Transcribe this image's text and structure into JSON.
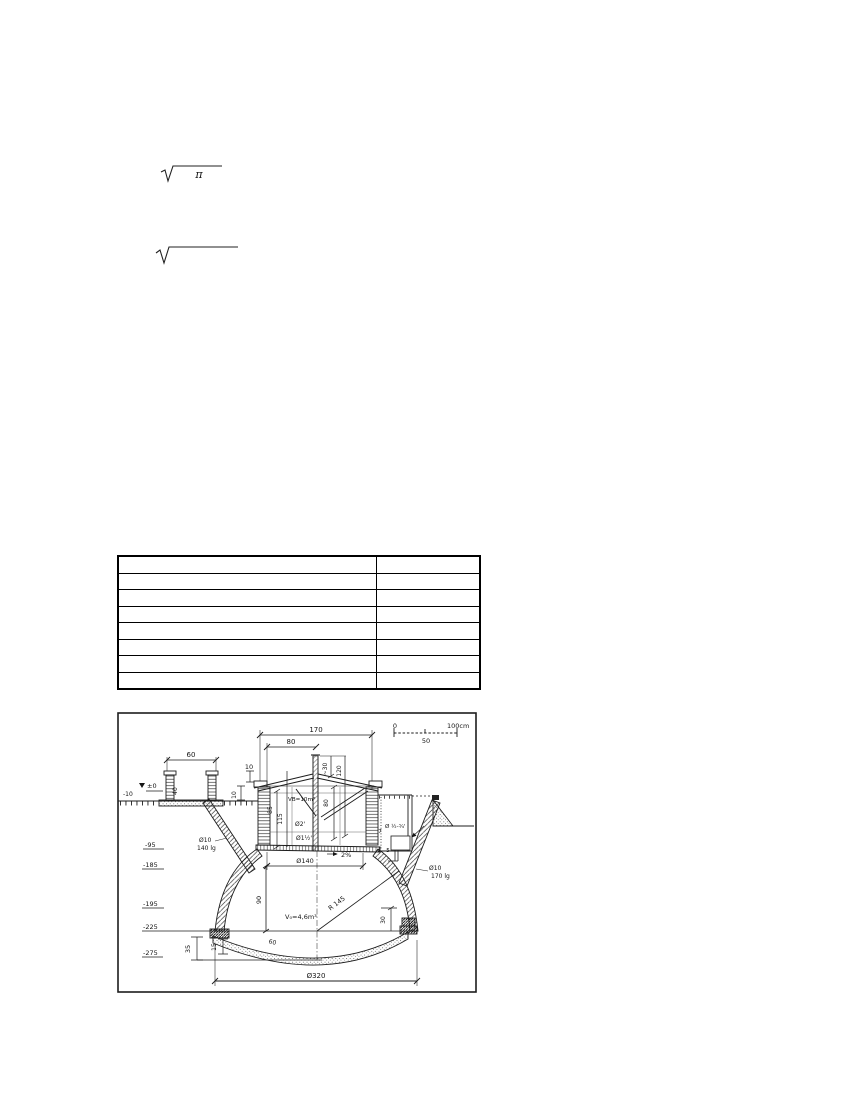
{
  "page": {
    "bg": "#ffffff",
    "ink": "#161616"
  },
  "formulas": {
    "f1": {
      "radicand": "π"
    },
    "f2": {
      "radicand": ""
    }
  },
  "table": {
    "rows": 8,
    "cols": 2,
    "col_widths_px": [
      258,
      104
    ],
    "cells": [
      [
        "",
        ""
      ],
      [
        "",
        ""
      ],
      [
        "",
        ""
      ],
      [
        "",
        ""
      ],
      [
        "",
        ""
      ],
      [
        "",
        ""
      ],
      [
        "",
        ""
      ],
      [
        "",
        ""
      ]
    ]
  },
  "figure": {
    "scale_bar": {
      "start": "0",
      "mid": "50",
      "end": "100cm"
    },
    "elevations": {
      "e0": "±0",
      "em10": "-10",
      "em95": "-95",
      "em185": "-185",
      "em195": "-195",
      "em225": "-225",
      "em275": "-275"
    },
    "dims": {
      "d170": "170",
      "d80_top": "80",
      "d60": "60",
      "d10_top": "10",
      "d10_side": "10",
      "d40_box": "40",
      "d30_pipe": "~30",
      "d120": "120",
      "d80_inner": "80",
      "d85": "85",
      "d115": "115",
      "d140": "Ø140",
      "d7": "7",
      "d5": "5",
      "d90": "90",
      "d30_right": "30",
      "d35": "35",
      "d15": "15",
      "d60_floor": "60",
      "d320": "Ø320",
      "r145": "R 145",
      "slope": "2%"
    },
    "labels": {
      "vb": "VB=10m³",
      "v0": "V₀=4,6m³",
      "pipe2": "Ø2'",
      "pipe15": "Ø1½'",
      "filter": "Ø ½-¾'",
      "rebar_left_1": "Ø10",
      "rebar_left_2": "140 lg",
      "rebar_right_1": "Ø10",
      "rebar_right_2": "170 lg"
    }
  }
}
